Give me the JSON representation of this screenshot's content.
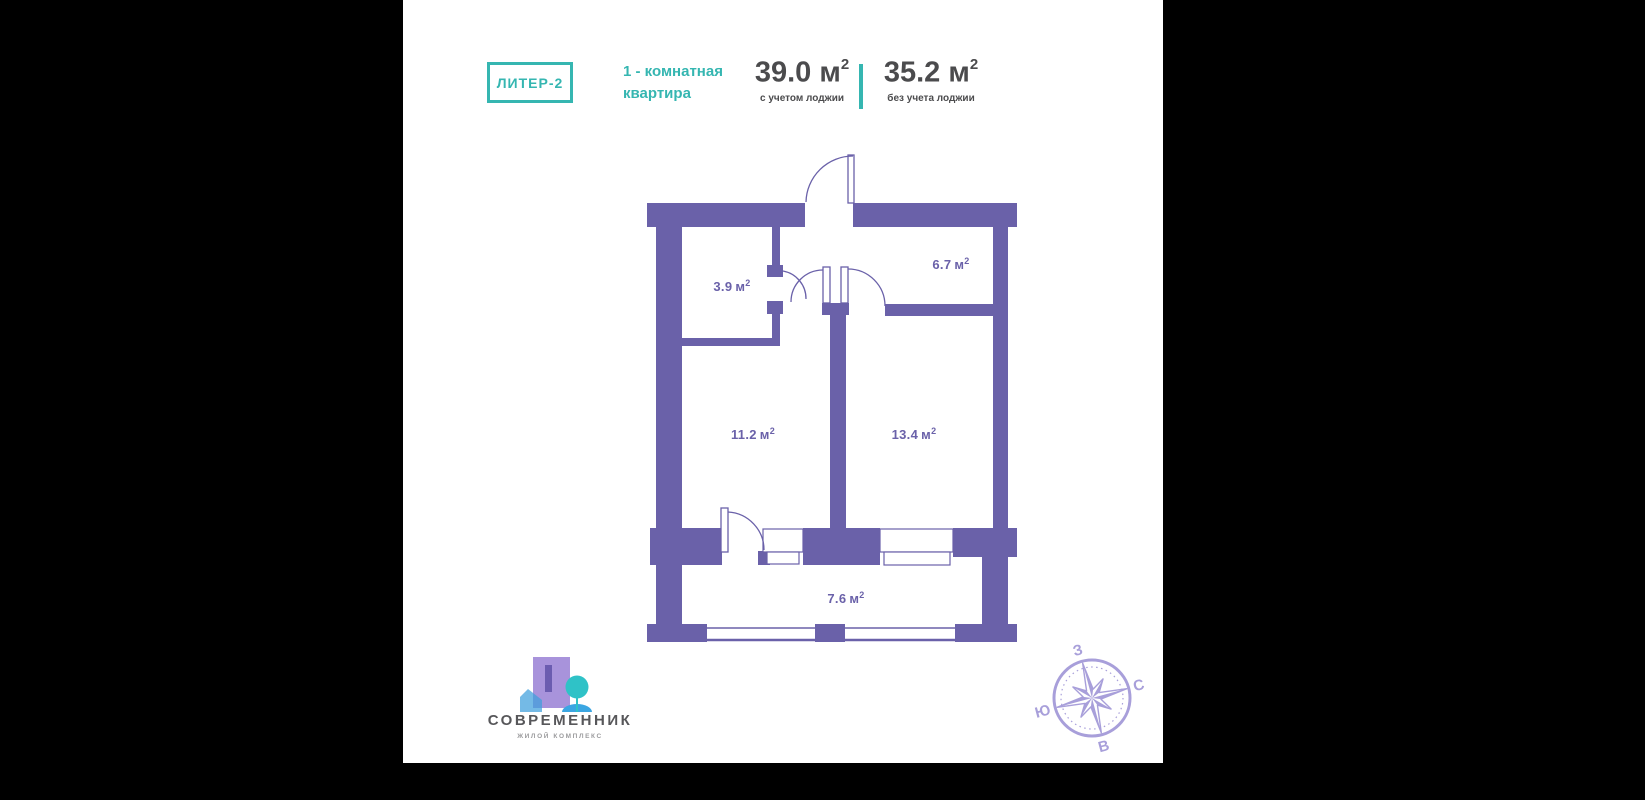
{
  "header": {
    "badge": "ЛИТЕР-2",
    "title_line1": "1 - комнатная",
    "title_line2": "квартира",
    "area_with": {
      "value": "39.0",
      "unit": "м",
      "sup": "2",
      "caption": "с учетом лоджии"
    },
    "area_without": {
      "value": "35.2",
      "unit": "м",
      "sup": "2",
      "caption": "без учета лоджии"
    }
  },
  "plan": {
    "rooms": [
      {
        "id": "bathroom",
        "value": "3.9",
        "unit": "м",
        "sup": "2"
      },
      {
        "id": "hallway",
        "value": "6.7",
        "unit": "м",
        "sup": "2"
      },
      {
        "id": "kitchen",
        "value": "11.2",
        "unit": "м",
        "sup": "2"
      },
      {
        "id": "living-room",
        "value": "13.4",
        "unit": "м",
        "sup": "2"
      },
      {
        "id": "loggia",
        "value": "7.6",
        "unit": "м",
        "sup": "2"
      }
    ]
  },
  "logo": {
    "title": "СОВРЕМЕННИК",
    "subtitle": "ЖИЛОЙ КОМПЛЕКС"
  },
  "compass": {
    "top": "З",
    "right": "С",
    "bottom": "В",
    "left": "Ю"
  },
  "colors": {
    "accent_teal": "#35b6b1",
    "wall_purple": "#6a61a9",
    "text_dark": "#4b4b4d",
    "compass_purple": "#a89fda",
    "side_bars": "#000000"
  }
}
